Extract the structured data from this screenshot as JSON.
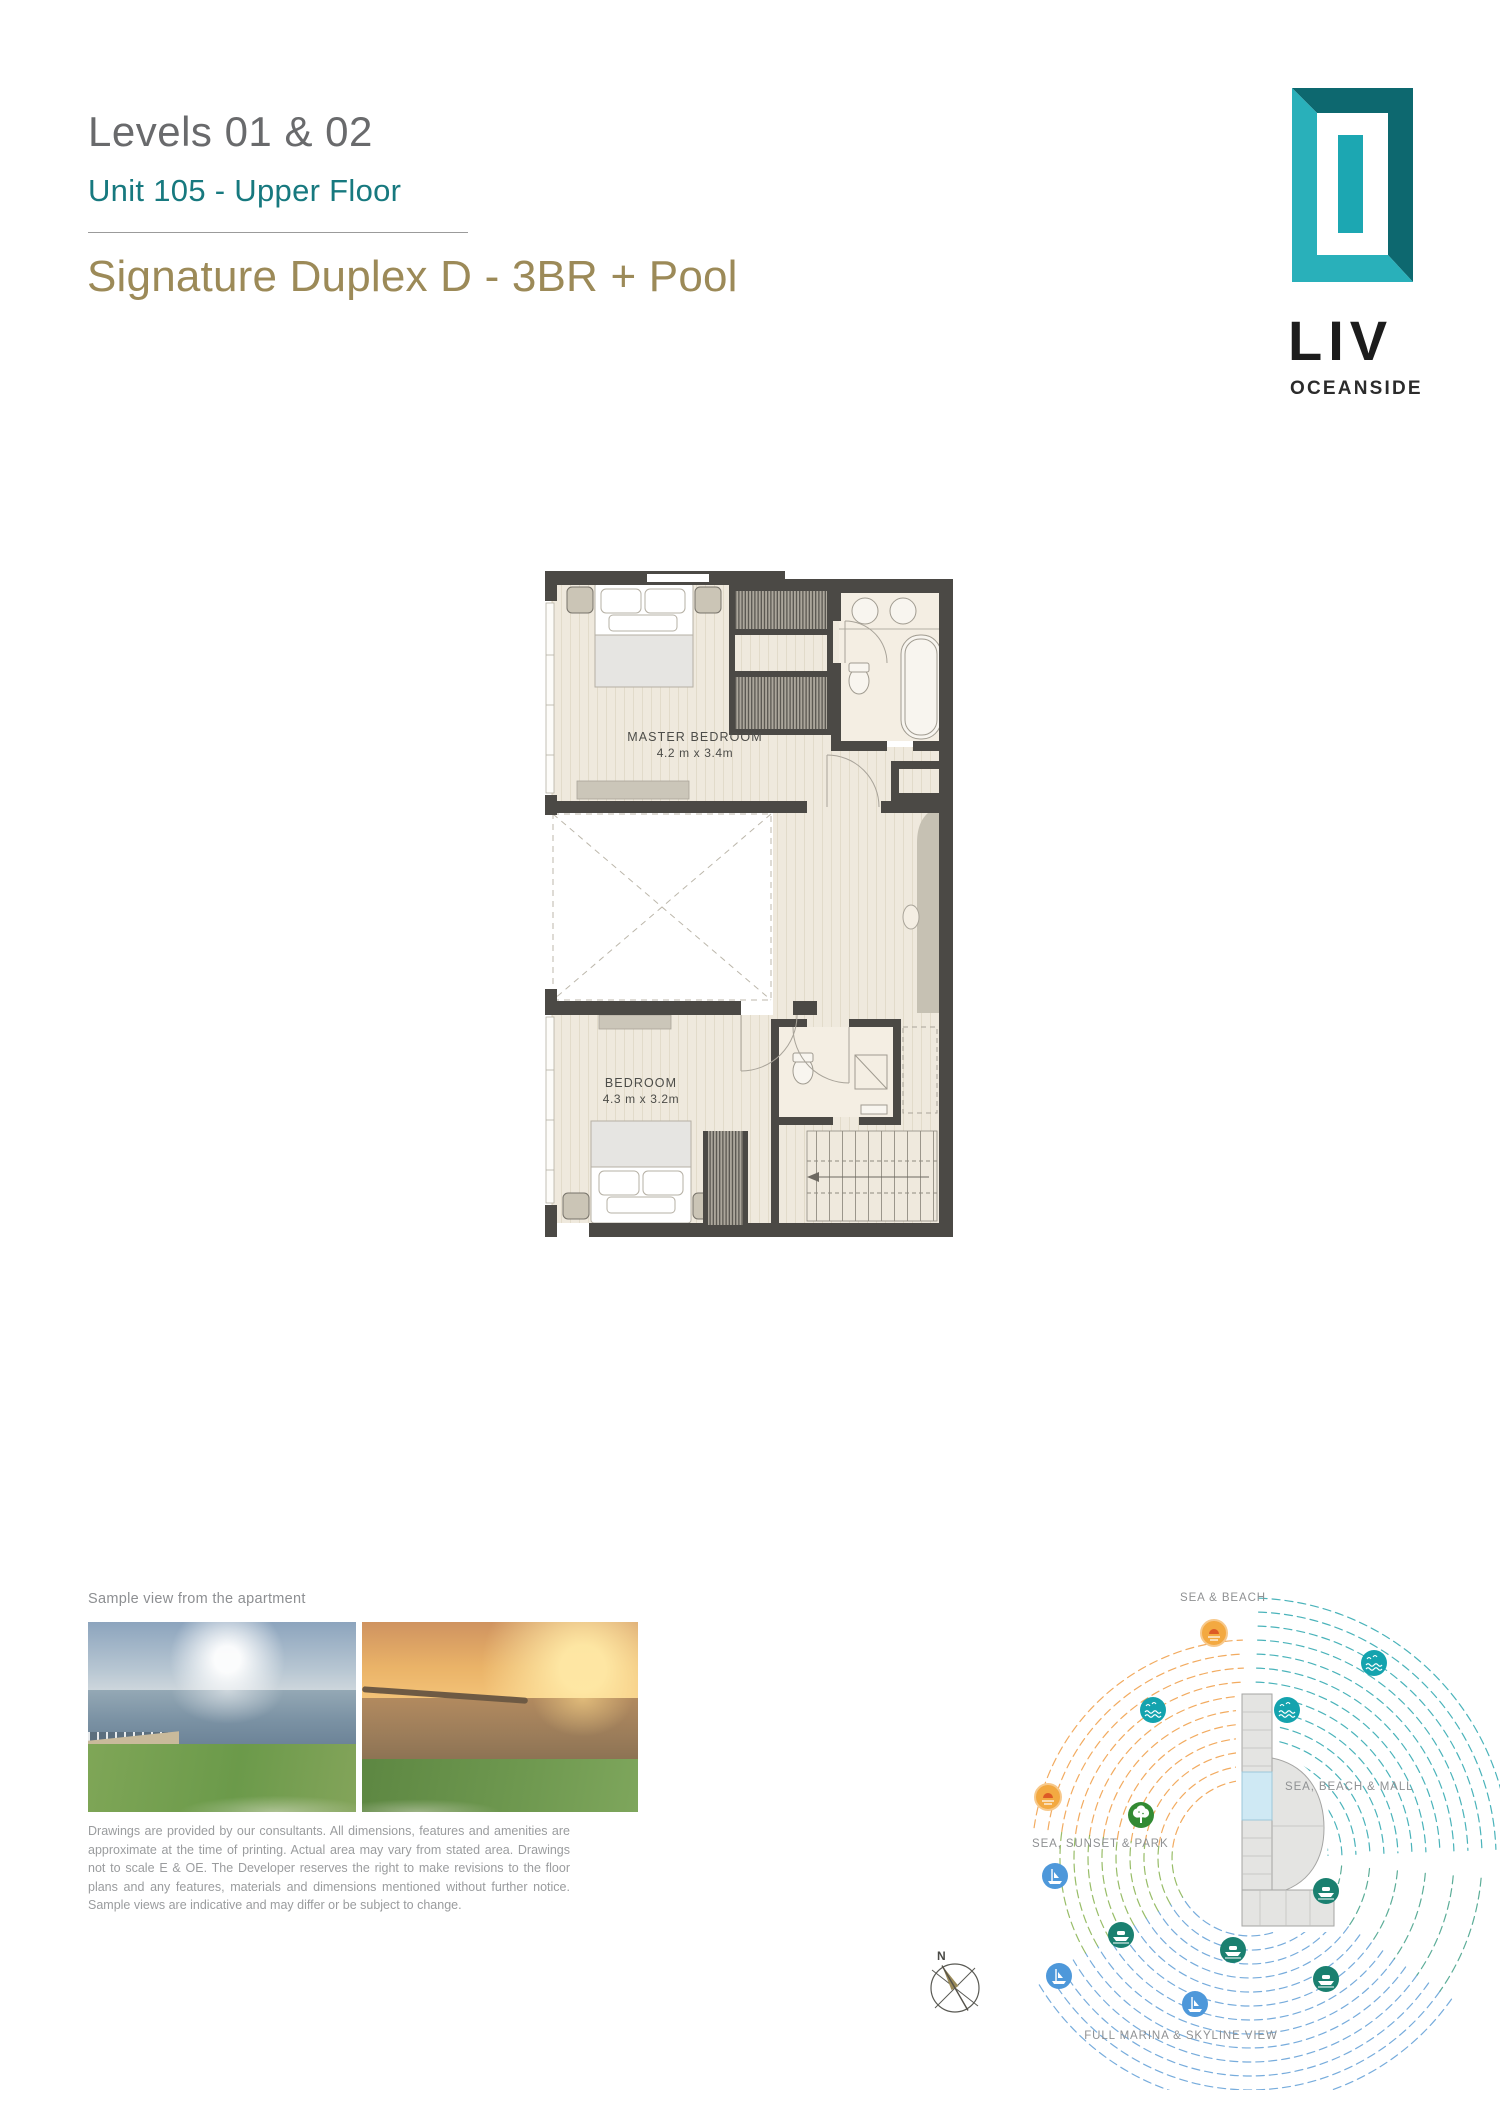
{
  "header": {
    "levels": "Levels 01 & 02",
    "unit": "Unit 105 - Upper Floor",
    "plan_title": "Signature Duplex D - 3BR + Pool"
  },
  "brand": {
    "name": "LIV",
    "sub_name": "OCEANSIDE"
  },
  "floor_plan": {
    "master_bedroom": {
      "name": "MASTER BEDROOM",
      "dims": "4.2 m x 3.4m"
    },
    "bedroom": {
      "name": "BEDROOM",
      "dims": "4.3 m x 3.2m"
    }
  },
  "views": {
    "caption": "Sample view from the apartment",
    "disclaimer": "Drawings are provided by our consultants. All dimensions, features and amenities are approximate at the time of printing. Actual area may vary from stated area.  Drawings not to scale E & OE.  The Developer reserves the right to make revisions to the floor plans and any features, materials and dimensions mentioned without further notice.  Sample views are indicative and may differ or be subject to change."
  },
  "site_map": {
    "label_top": "SEA & BEACH",
    "label_right": "SEA, BEACH & MALL",
    "label_left": "SEA, SUNSET & PARK",
    "label_bottom": "FULL MARINA & SKYLINE VIEW",
    "compass_north": "N"
  },
  "icons": {
    "sun_beach": "sun-over-beach",
    "sunset": "sunset-over-sea",
    "sea_wave": "sea-waves",
    "tree_park": "park-tree",
    "marina": "marina-skyline",
    "yacht": "yacht-boat"
  },
  "colors": {
    "teal": "#17797f",
    "gold": "#9c8a58",
    "title_gray": "#696a6c",
    "logo_teal_light": "#29b0ba",
    "logo_teal_dark": "#0d686f",
    "wall_dark": "#4b4945",
    "floor_beige": "#efe9dd",
    "arc_teal": "#2aa6ae",
    "arc_orange": "#f09c44",
    "arc_blue": "#5f9ed6",
    "arc_green": "#86b14e",
    "icon_sea_teal": "#14a3ae",
    "icon_marina_blue": "#4e98da",
    "icon_yacht_green": "#1a8070",
    "icon_tree_green": "#338a33",
    "label_gray": "#8f9193"
  }
}
